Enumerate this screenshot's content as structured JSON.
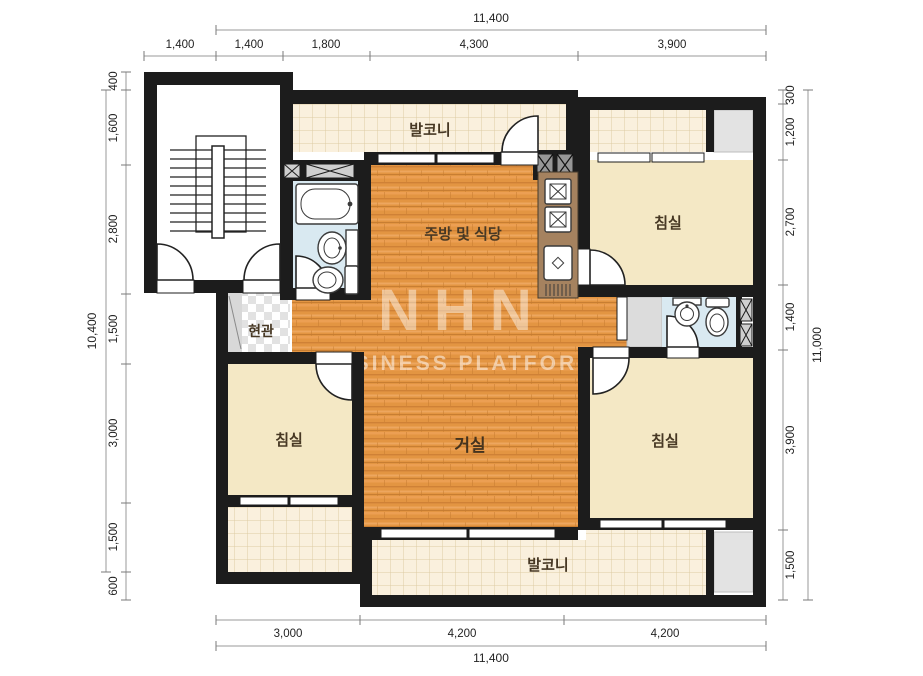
{
  "plan": {
    "type": "apartment-floor-plan",
    "watermark": {
      "line1": "NHN",
      "line2": "BUSINESS PLATFORM"
    }
  },
  "rooms": {
    "balcony_top": {
      "label": "발코니"
    },
    "kitchen_dining": {
      "label": "주방 및 식당"
    },
    "bedroom_top_right": {
      "label": "침실"
    },
    "entrance": {
      "label": "현관"
    },
    "bedroom_left": {
      "label": "침실"
    },
    "living_room": {
      "label": "거실"
    },
    "bedroom_bottom_right": {
      "label": "침실"
    },
    "balcony_bottom": {
      "label": "발코니"
    }
  },
  "dimensions": {
    "top": {
      "total": "11,400",
      "segments": [
        "1,400",
        "1,400",
        "1,800",
        "4,300",
        "3,900"
      ]
    },
    "bottom": {
      "total": "11,400",
      "segments": [
        "3,000",
        "4,200",
        "4,200"
      ]
    },
    "left": {
      "total": "10,400",
      "segments": [
        "400",
        "1,600",
        "2,800",
        "1,500",
        "3,000",
        "1,500",
        "600"
      ]
    },
    "right": {
      "total": "11,000",
      "segments": [
        "300",
        "1,200",
        "2,700",
        "1,400",
        "3,900",
        "1,500"
      ]
    }
  },
  "colors": {
    "wall": "#1c1c1c",
    "wood_floor": "#e39542",
    "balcony_tile": "#faf0dd",
    "bedroom_floor": "#f4e8c5",
    "bathroom_floor": "#d9e9f1",
    "counter": "#a5825f",
    "utility_gray": "#e3e3e3"
  }
}
